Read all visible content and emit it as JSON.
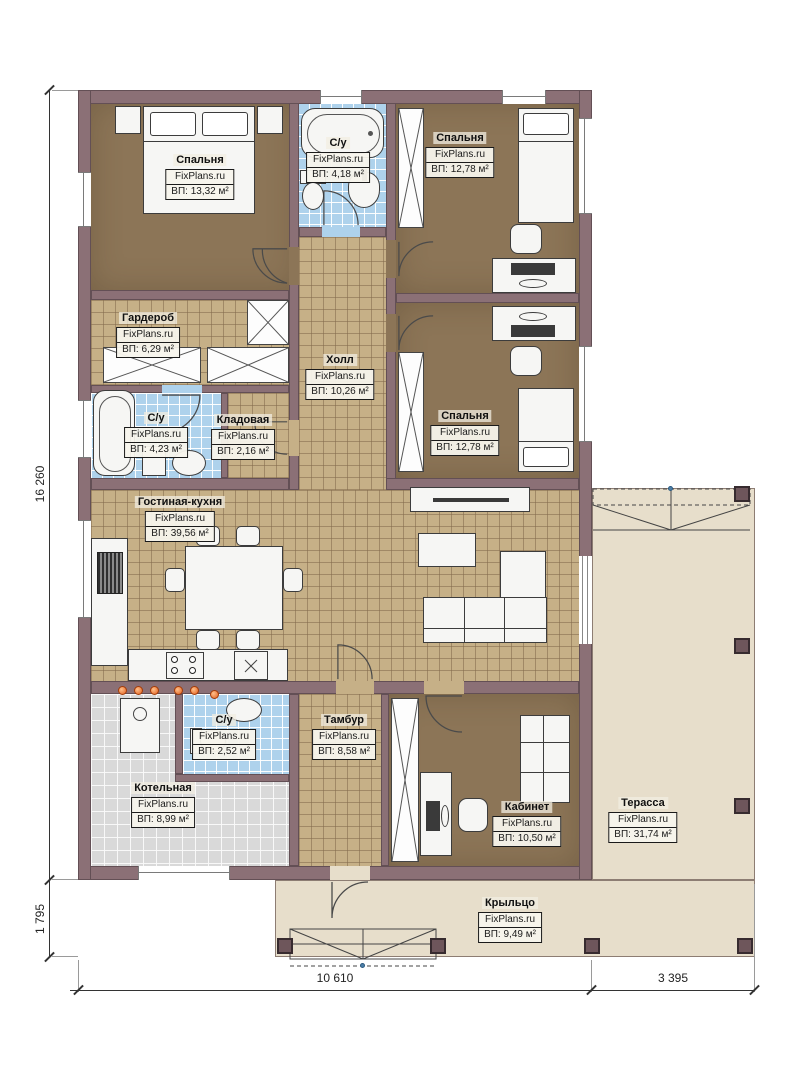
{
  "watermark": "FixPlans.ru",
  "rooms": [
    {
      "id": "bedroom-top-left",
      "name": "Спальня",
      "area": "ВП: 13,32 м²"
    },
    {
      "id": "bathroom-top",
      "name": "С/у",
      "area": "ВП: 4,18 м²"
    },
    {
      "id": "bedroom-top-right",
      "name": "Спальня",
      "area": "ВП: 12,78 м²"
    },
    {
      "id": "wardrobe",
      "name": "Гардероб",
      "area": "ВП: 6,29 м²"
    },
    {
      "id": "hall",
      "name": "Холл",
      "area": "ВП: 10,26 м²"
    },
    {
      "id": "bathroom-middle",
      "name": "С/у",
      "area": "ВП: 4,23 м²"
    },
    {
      "id": "storage",
      "name": "Кладовая",
      "area": "ВП: 2,16 м²"
    },
    {
      "id": "bedroom-middle-right",
      "name": "Спальня",
      "area": "ВП: 12,78 м²"
    },
    {
      "id": "living-kitchen",
      "name": "Гостиная-кухня",
      "area": "ВП: 39,56 м²"
    },
    {
      "id": "boiler-room",
      "name": "Котельная",
      "area": "ВП: 8,99 м²"
    },
    {
      "id": "bathroom-bottom",
      "name": "С/у",
      "area": "ВП: 2,52 м²"
    },
    {
      "id": "vestibule",
      "name": "Тамбур",
      "area": "ВП: 8,58 м²"
    },
    {
      "id": "office",
      "name": "Кабинет",
      "area": "ВП: 10,50 м²"
    },
    {
      "id": "terrace",
      "name": "Терасса",
      "area": "ВП: 31,74 м²"
    },
    {
      "id": "porch",
      "name": "Крыльцо",
      "area": "ВП: 9,49 м²"
    }
  ],
  "dimensions": {
    "height_total": "16 260",
    "porch_height": "1 795",
    "width_house": "10 610",
    "width_terrace": "3 395"
  },
  "colors": {
    "wall": "#8b7076",
    "bedroom_floor": "#8c7557",
    "tile_floor": "#c6b087",
    "bath_floor": "#aed2ec",
    "boiler_floor": "#d9d9d9",
    "terrace_floor": "#e7decb",
    "heating_accent": "#e2601f"
  }
}
